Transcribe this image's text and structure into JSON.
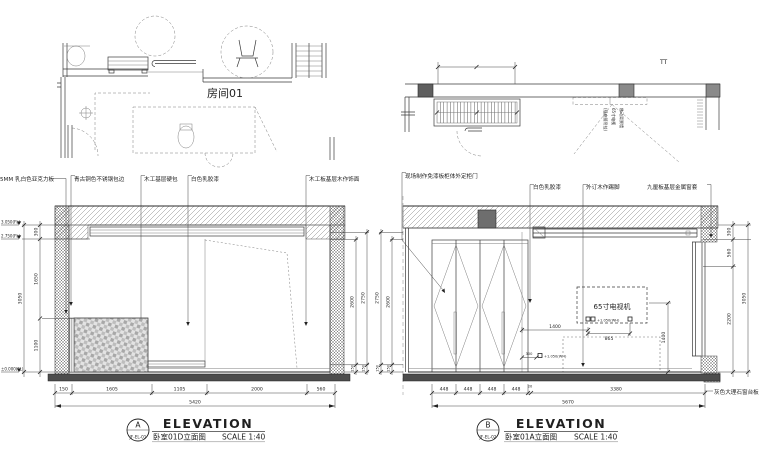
{
  "plan_left": {
    "room_label": "房间01"
  },
  "plan_right": {
    "corner_mark": "TT",
    "tv_note": [
      "移动背景墙",
      "65寸电视",
      "(插座随吊挂)"
    ]
  },
  "materials_left": [
    "5MM 乳白色亚克力板",
    "青古铜色不锈钢包边",
    "木工基层硬包",
    "白色乳胶漆",
    "木工板基层木作饰面"
  ],
  "materials_right": [
    "现场制作免漆板柜体外定柜门",
    "白色乳胶漆",
    "外订木作踢脚",
    "九厘板基层金属窗套",
    "灰色大理石窗台板"
  ],
  "elev_a": {
    "levels": [
      "3.050(FL)",
      "2.750(FL)",
      "±0.000(FL)"
    ],
    "left_dims": [
      "300",
      "1650",
      "1100"
    ],
    "left_total": "3050",
    "right_dims": [
      "2600",
      "2750"
    ],
    "right_small": "150",
    "bottom_dims": [
      "150",
      "1605",
      "1105",
      "2000",
      "560"
    ],
    "bottom_total": "5420",
    "tag": "A",
    "code": "JF-EL-01",
    "title": "ELEVATION",
    "subtitle": "卧室01D立面图",
    "scale": "SCALE 1:40"
  },
  "elev_b": {
    "left_dims": [
      "2750",
      "2600"
    ],
    "left_small": "150",
    "right_dims": [
      "300",
      "560",
      "2200"
    ],
    "right_total": "3050",
    "bottom_dims": [
      "448",
      "448",
      "448",
      "448",
      "20",
      "3380"
    ],
    "bottom_total": "5670",
    "tv_label": "65寸电视机",
    "dim_1400_h": "1400",
    "dim_865": "865",
    "dim_300": "300",
    "dim_1400_v": "1400",
    "socket_note_1": "+1.050(WH)",
    "socket_note_2": "+1.050(WH)",
    "tag": "B",
    "code": "JF-EL-02",
    "title": "ELEVATION",
    "subtitle": "卧室01A立面图",
    "scale": "SCALE 1:40"
  }
}
